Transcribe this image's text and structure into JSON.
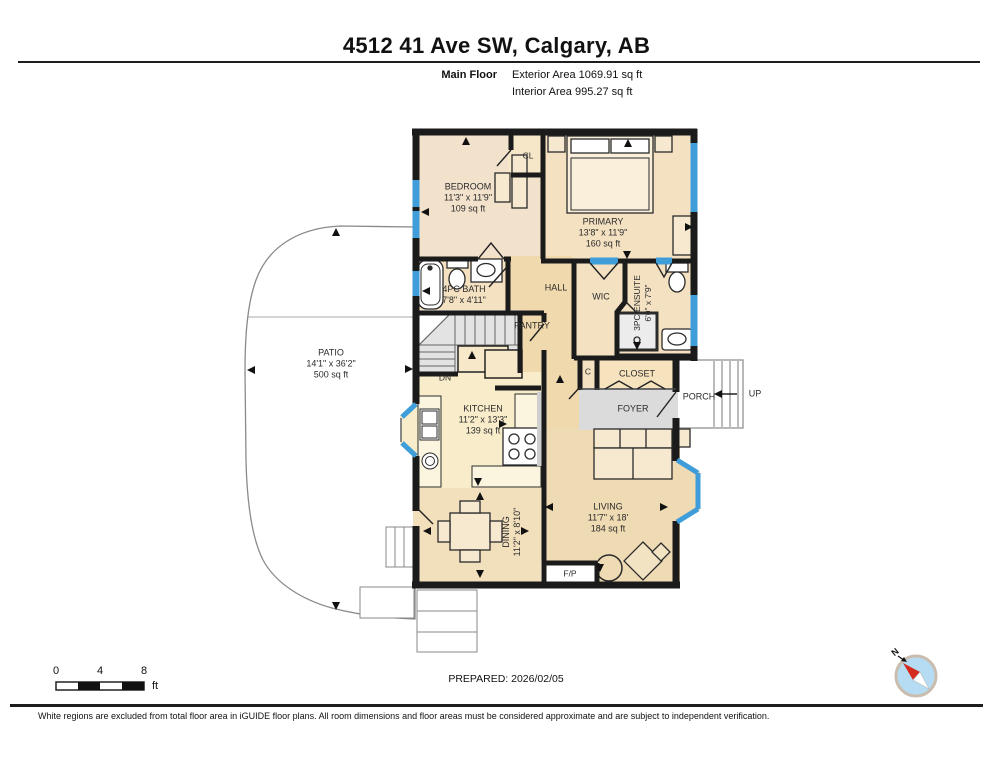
{
  "header": {
    "title": "4512 41 Ave SW, Calgary, AB",
    "floor_label": "Main Floor",
    "exterior_area": "Exterior Area 1069.91 sq ft",
    "interior_area": "Interior Area 995.27 sq ft"
  },
  "rooms": {
    "bedroom": {
      "name": "BEDROOM",
      "dims": "11'3\" x 11'9\"",
      "area": "109 sq ft"
    },
    "closet_cl": {
      "name": "CL"
    },
    "primary": {
      "name": "PRIMARY",
      "dims": "13'8\" x 11'9\"",
      "area": "160 sq ft"
    },
    "bath": {
      "name": "4PC BATH",
      "dims": "7'8\" x 4'11\""
    },
    "hall": {
      "name": "HALL"
    },
    "wic": {
      "name": "WIC"
    },
    "ensuite": {
      "name": "3PC ENSUITE",
      "dims": "6'0\" x 7'9\""
    },
    "pantry": {
      "name": "PANTRY"
    },
    "stairs_down": {
      "name": "DN"
    },
    "closet_c": {
      "name": "C"
    },
    "closet": {
      "name": "CLOSET"
    },
    "foyer": {
      "name": "FOYER"
    },
    "porch": {
      "name": "PORCH"
    },
    "stairs_up": {
      "name": "UP"
    },
    "kitchen": {
      "name": "KITCHEN",
      "dims": "11'2\" x 13'3\"",
      "area": "139 sq ft"
    },
    "dining": {
      "name": "DINING",
      "dims": "11'2\" x 8'10\""
    },
    "living": {
      "name": "LIVING",
      "dims": "11'7\" x 18'",
      "area": "184 sq ft"
    },
    "fireplace": {
      "name": "F/P"
    },
    "patio": {
      "name": "PATIO",
      "dims": "14'1\" x 36'2\"",
      "area": "500 sq ft"
    }
  },
  "scale_bar": {
    "tick_0": "0",
    "tick_4": "4",
    "tick_8": "8",
    "unit": "ft"
  },
  "compass": {
    "north": "N"
  },
  "footer": {
    "prepared": "PREPARED: 2026/02/05",
    "disclaimer": "White regions are excluded from total floor area in iGUIDE floor plans. All room dimensions and floor areas must be considered approximate and are subject to independent verification."
  },
  "colors": {
    "wall": "#1b1b1b",
    "window_blue": "#3f9ed9",
    "floor_warm": "#f4e1c2",
    "floor_yellow": "#f8ecca",
    "floor_tan": "#efdbb3",
    "hall_tan": "#f0d9ad",
    "foyer_gray": "#dbdbdb",
    "stairs_gray": "#e3e3e3"
  }
}
